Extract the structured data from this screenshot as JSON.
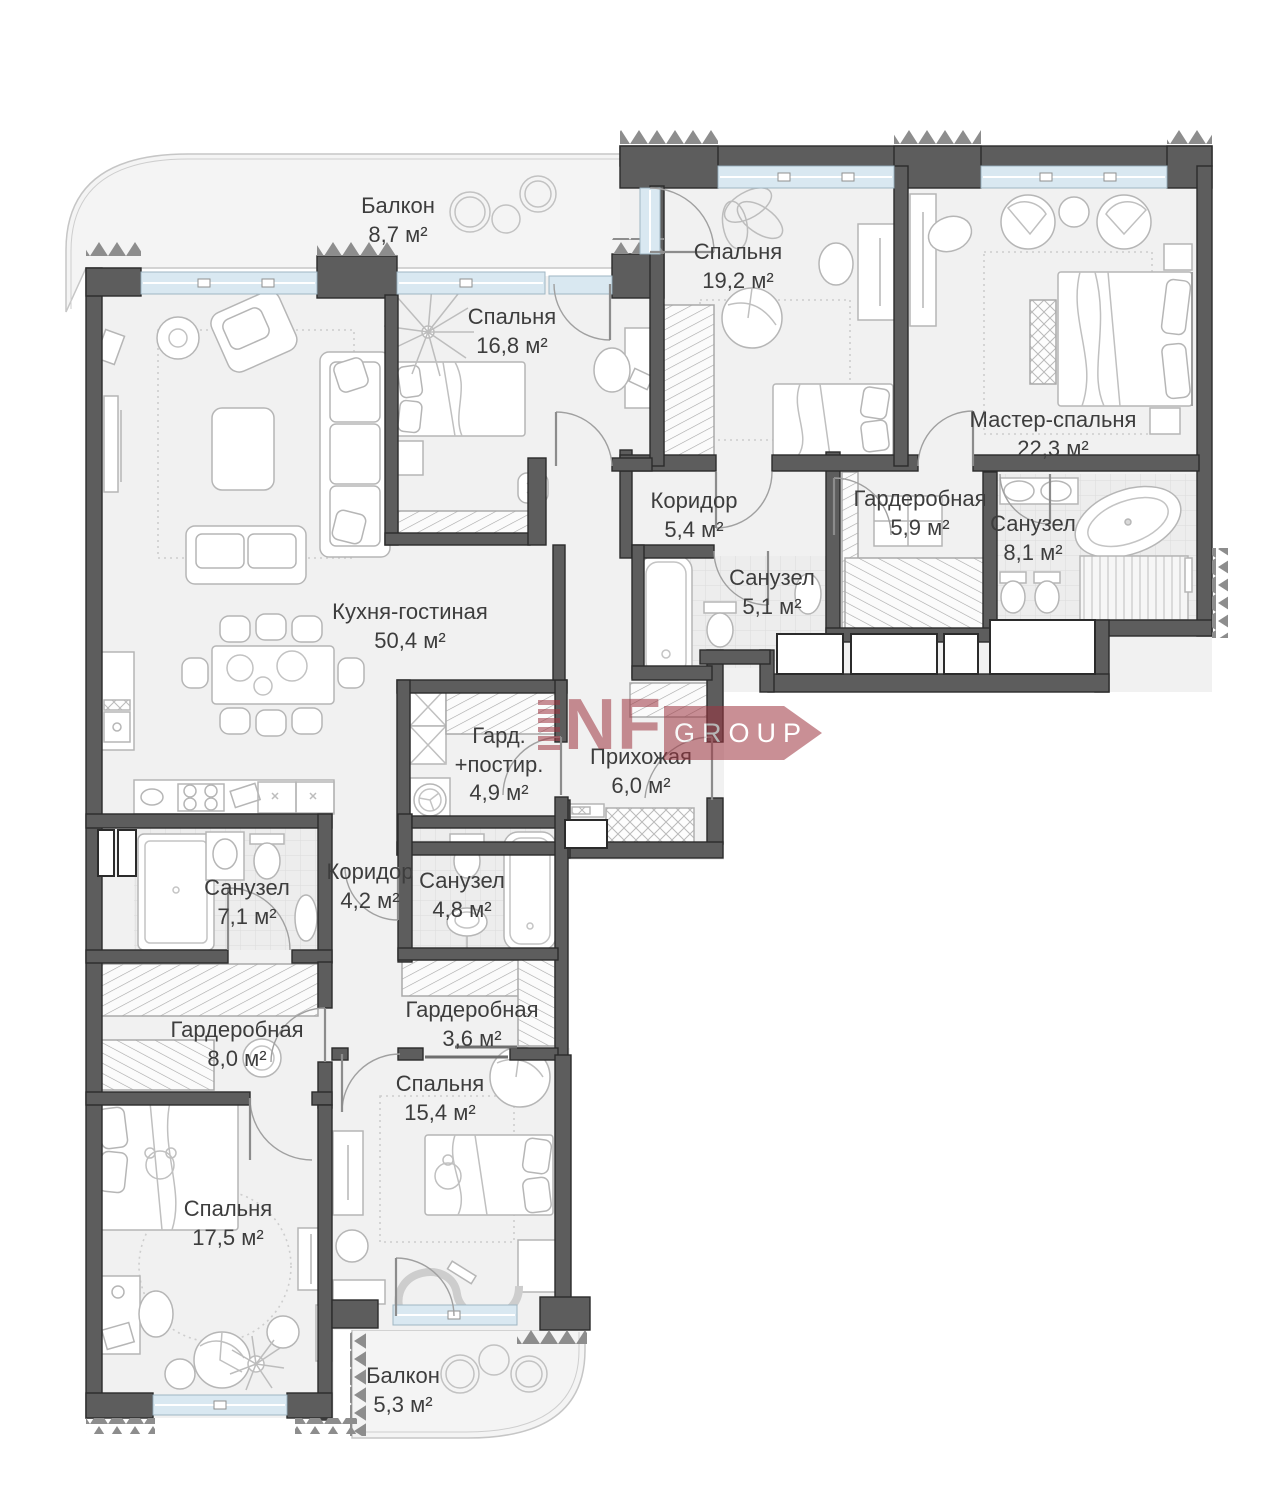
{
  "title": "План квартиры",
  "watermark": {
    "brand": "NF",
    "suffix": "GROUP",
    "color": "#9e3540"
  },
  "rooms": [
    {
      "id": "balcony-top",
      "name": "Балкон",
      "area": "8,7 м²"
    },
    {
      "id": "bedroom-168",
      "name": "Спальня",
      "area": "16,8 м²"
    },
    {
      "id": "bedroom-192",
      "name": "Спальня",
      "area": "19,2 м²"
    },
    {
      "id": "master-bedroom",
      "name": "Мастер-спальня",
      "area": "22,3 м²"
    },
    {
      "id": "bathroom-81",
      "name": "Санузел",
      "area": "8,1 м²"
    },
    {
      "id": "corridor-54",
      "name": "Коридор",
      "area": "5,4 м²"
    },
    {
      "id": "wardrobe-59",
      "name": "Гардеробная",
      "area": "5,9 м²"
    },
    {
      "id": "bathroom-51",
      "name": "Санузел",
      "area": "5,1 м²"
    },
    {
      "id": "kitchen-living",
      "name": "Кухня-гостиная",
      "area": "50,4 м²"
    },
    {
      "id": "laundry",
      "name": "Гард. +постир.",
      "area": "4,9 м²"
    },
    {
      "id": "hallway",
      "name": "Прихожая",
      "area": "6,0 м²"
    },
    {
      "id": "bathroom-71",
      "name": "Санузел",
      "area": "7,1 м²"
    },
    {
      "id": "corridor-42",
      "name": "Коридор",
      "area": "4,2 м²"
    },
    {
      "id": "bathroom-48",
      "name": "Санузел",
      "area": "4,8 м²"
    },
    {
      "id": "wardrobe-80",
      "name": "Гардеробная",
      "area": "8,0 м²"
    },
    {
      "id": "wardrobe-36",
      "name": "Гардеробная",
      "area": "3,6 м²"
    },
    {
      "id": "bedroom-154",
      "name": "Спальня",
      "area": "15,4 м²"
    },
    {
      "id": "bedroom-175",
      "name": "Спальня",
      "area": "17,5 м²"
    },
    {
      "id": "balcony-bottom",
      "name": "Балкон",
      "area": "5,3 м²"
    }
  ]
}
